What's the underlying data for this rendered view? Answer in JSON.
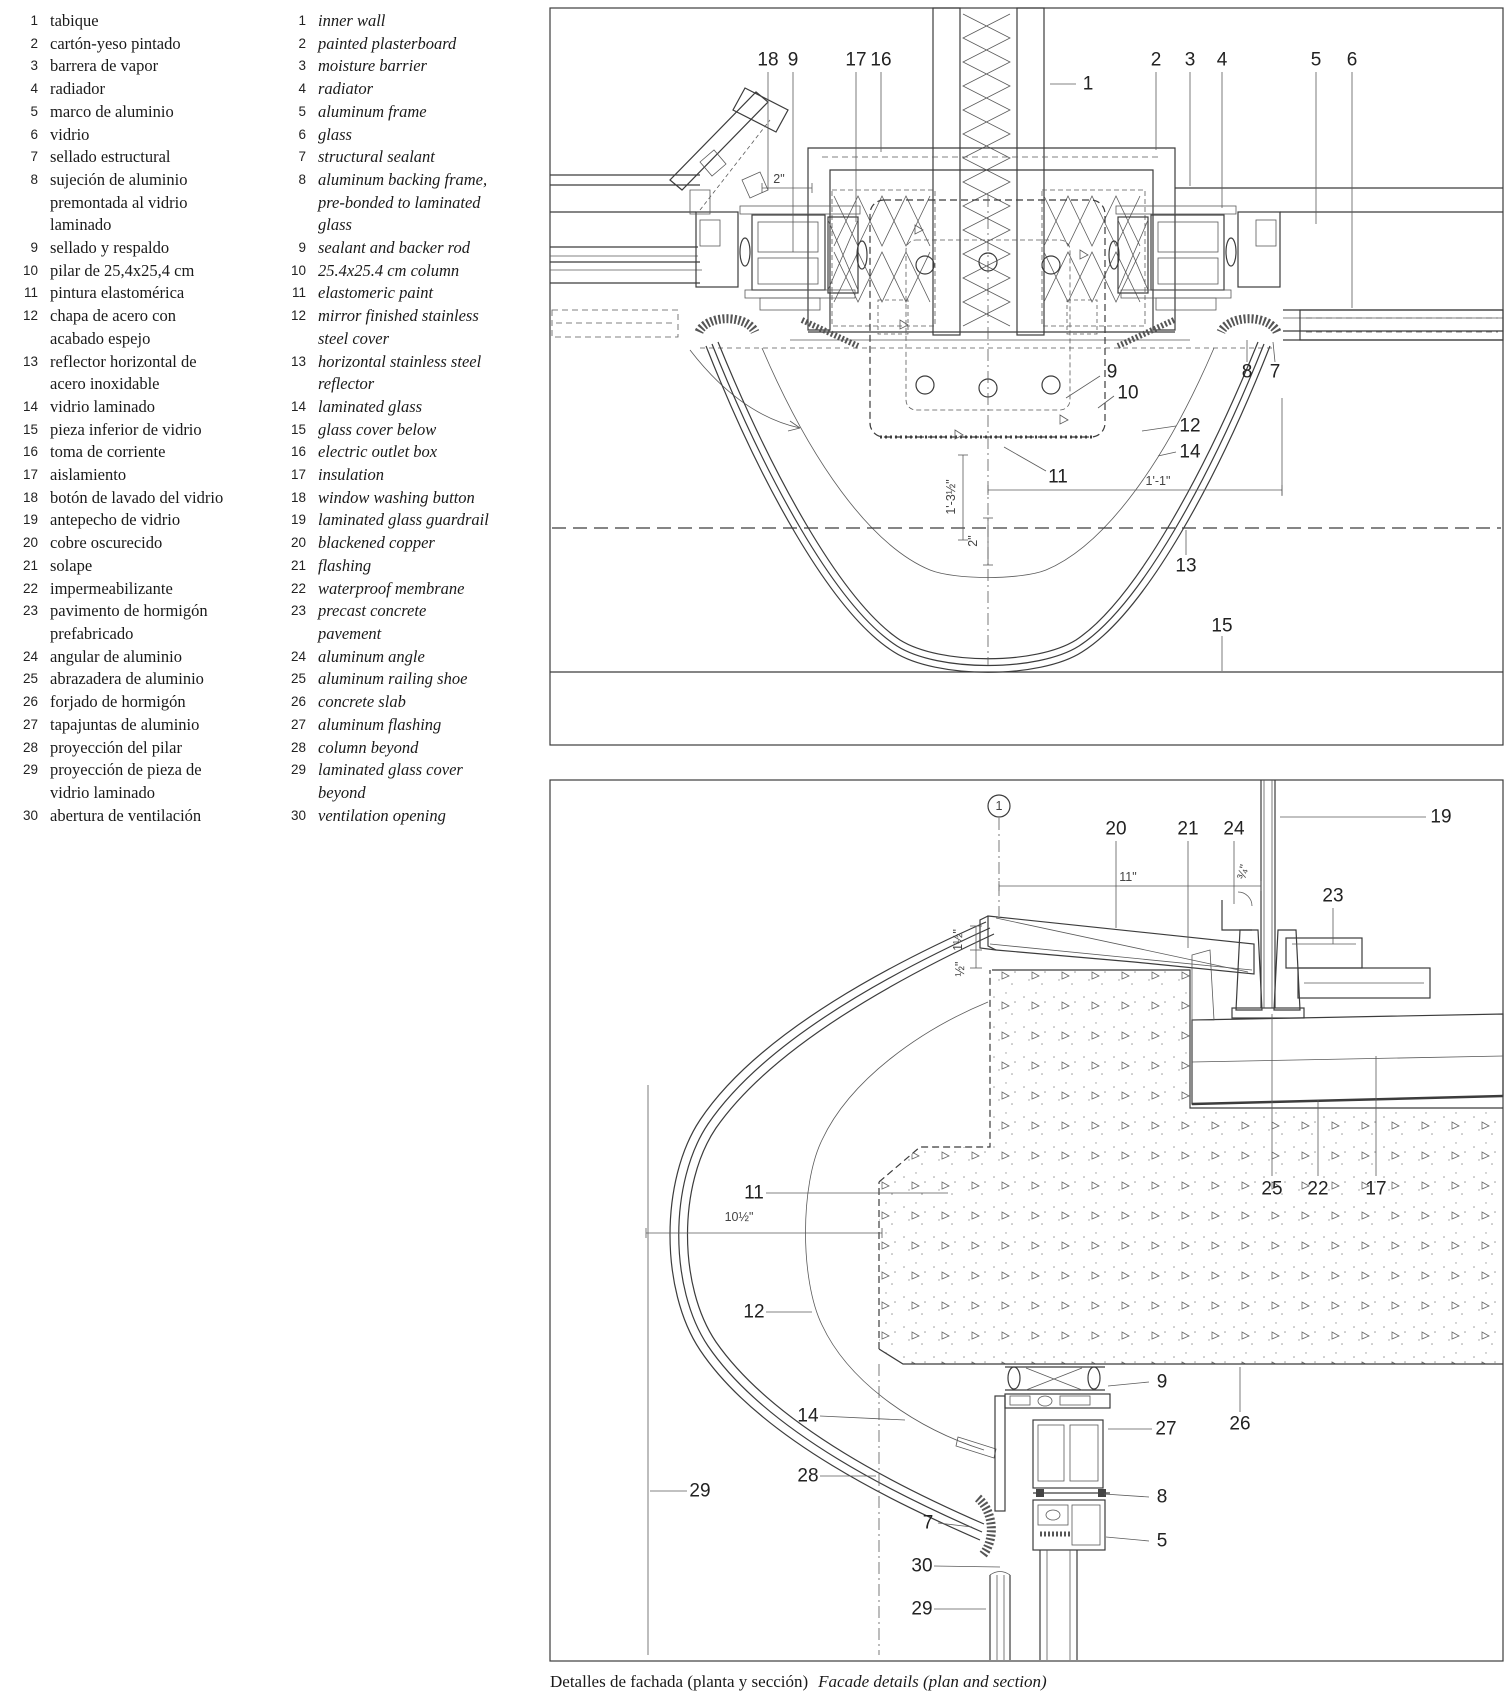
{
  "colors": {
    "line": "#3c3c3c",
    "text": "#1a1a1a",
    "pattern": "#888888"
  },
  "legend": {
    "es": [
      {
        "num": "1",
        "text": "tabique"
      },
      {
        "num": "2",
        "text": "cartón-yeso pintado"
      },
      {
        "num": "3",
        "text": "barrera de vapor"
      },
      {
        "num": "4",
        "text": "radiador"
      },
      {
        "num": "5",
        "text": "marco de aluminio"
      },
      {
        "num": "6",
        "text": "vidrio"
      },
      {
        "num": "7",
        "text": "sellado estructural"
      },
      {
        "num": "8",
        "text": "sujeción de aluminio\npremontada al vidrio\nlaminado"
      },
      {
        "num": "9",
        "text": "sellado y respaldo"
      },
      {
        "num": "10",
        "text": "pilar de 25,4x25,4 cm"
      },
      {
        "num": "11",
        "text": "pintura elastomérica"
      },
      {
        "num": "12",
        "text": "chapa de acero con\nacabado espejo"
      },
      {
        "num": "13",
        "text": "reflector horizontal de\nacero inoxidable"
      },
      {
        "num": "14",
        "text": "vidrio laminado"
      },
      {
        "num": "15",
        "text": "pieza inferior de vidrio"
      },
      {
        "num": "16",
        "text": "toma de corriente"
      },
      {
        "num": "17",
        "text": "aislamiento"
      },
      {
        "num": "18",
        "text": "botón de lavado del vidrio"
      },
      {
        "num": "19",
        "text": "antepecho de vidrio"
      },
      {
        "num": "20",
        "text": "cobre oscurecido"
      },
      {
        "num": "21",
        "text": "solape"
      },
      {
        "num": "22",
        "text": "impermeabilizante"
      },
      {
        "num": "23",
        "text": "pavimento de hormigón\nprefabricado"
      },
      {
        "num": "24",
        "text": "angular de aluminio"
      },
      {
        "num": "25",
        "text": "abrazadera de aluminio"
      },
      {
        "num": "26",
        "text": "forjado de hormigón"
      },
      {
        "num": "27",
        "text": "tapajuntas de aluminio"
      },
      {
        "num": "28",
        "text": "proyección del pilar"
      },
      {
        "num": "29",
        "text": "proyección de pieza de\nvidrio laminado"
      },
      {
        "num": "30",
        "text": "abertura de ventilación"
      }
    ],
    "en": [
      {
        "num": "1",
        "text": "inner wall"
      },
      {
        "num": "2",
        "text": "painted plasterboard"
      },
      {
        "num": "3",
        "text": "moisture barrier"
      },
      {
        "num": "4",
        "text": "radiator"
      },
      {
        "num": "5",
        "text": "aluminum frame"
      },
      {
        "num": "6",
        "text": "glass"
      },
      {
        "num": "7",
        "text": "structural sealant"
      },
      {
        "num": "8",
        "text": "aluminum backing frame,\npre-bonded to laminated\nglass"
      },
      {
        "num": "9",
        "text": "sealant and backer rod"
      },
      {
        "num": "10",
        "text": "25.4x25.4 cm column"
      },
      {
        "num": "11",
        "text": "elastomeric paint"
      },
      {
        "num": "12",
        "text": "mirror finished stainless\nsteel cover"
      },
      {
        "num": "13",
        "text": "horizontal stainless steel\nreflector"
      },
      {
        "num": "14",
        "text": "laminated glass"
      },
      {
        "num": "15",
        "text": "glass cover below"
      },
      {
        "num": "16",
        "text": "electric outlet box"
      },
      {
        "num": "17",
        "text": "insulation"
      },
      {
        "num": "18",
        "text": "window washing button"
      },
      {
        "num": "19",
        "text": "laminated glass guardrail"
      },
      {
        "num": "20",
        "text": "blackened copper"
      },
      {
        "num": "21",
        "text": "flashing"
      },
      {
        "num": "22",
        "text": "waterproof membrane"
      },
      {
        "num": "23",
        "text": "precast concrete\npavement"
      },
      {
        "num": "24",
        "text": "aluminum angle"
      },
      {
        "num": "25",
        "text": "aluminum railing shoe"
      },
      {
        "num": "26",
        "text": "concrete slab"
      },
      {
        "num": "27",
        "text": "aluminum flashing"
      },
      {
        "num": "28",
        "text": "column beyond"
      },
      {
        "num": "29",
        "text": "laminated glass cover\nbeyond"
      },
      {
        "num": "30",
        "text": "ventilation opening"
      }
    ]
  },
  "caption": {
    "es": "Detalles de fachada (planta y sección)",
    "en": "Facade details (plan and section)"
  },
  "plan": {
    "labels": [
      {
        "t": "18",
        "x": 768,
        "y": 60,
        "l": [
          768,
          72,
          768,
          190
        ]
      },
      {
        "t": "9",
        "x": 793,
        "y": 60,
        "l": [
          793,
          72,
          793,
          252
        ]
      },
      {
        "t": "17",
        "x": 856,
        "y": 60,
        "l": [
          856,
          72,
          856,
          222
        ]
      },
      {
        "t": "16",
        "x": 881,
        "y": 60,
        "l": [
          881,
          72,
          881,
          152
        ]
      },
      {
        "t": "1",
        "x": 1088,
        "y": 84,
        "l": [
          1050,
          84,
          1076,
          84
        ]
      },
      {
        "t": "2",
        "x": 1156,
        "y": 60,
        "l": [
          1156,
          72,
          1156,
          150
        ]
      },
      {
        "t": "3",
        "x": 1190,
        "y": 60,
        "l": [
          1190,
          72,
          1190,
          186
        ]
      },
      {
        "t": "4",
        "x": 1222,
        "y": 60,
        "l": [
          1222,
          72,
          1222,
          208
        ]
      },
      {
        "t": "5",
        "x": 1316,
        "y": 60,
        "l": [
          1316,
          72,
          1316,
          224
        ]
      },
      {
        "t": "6",
        "x": 1352,
        "y": 60,
        "l": [
          1352,
          72,
          1352,
          308
        ]
      },
      {
        "t": "9",
        "x": 1112,
        "y": 372,
        "l": [
          1100,
          376,
          1066,
          398
        ]
      },
      {
        "t": "10",
        "x": 1128,
        "y": 393,
        "l": [
          1114,
          396,
          1098,
          408
        ]
      },
      {
        "t": "12",
        "x": 1190,
        "y": 426,
        "l": [
          1176,
          426,
          1142,
          431
        ]
      },
      {
        "t": "14",
        "x": 1190,
        "y": 452,
        "l": [
          1176,
          452,
          1158,
          456
        ]
      },
      {
        "t": "11",
        "x": 1058,
        "y": 477,
        "l": [
          1046,
          471,
          1004,
          447
        ]
      },
      {
        "t": "8",
        "x": 1247,
        "y": 372,
        "l": [
          1247,
          362,
          1247,
          340
        ]
      },
      {
        "t": "7",
        "x": 1275,
        "y": 372,
        "l": [
          1275,
          362,
          1273,
          342
        ]
      },
      {
        "t": "13",
        "x": 1186,
        "y": 566,
        "l": [
          1186,
          555,
          1186,
          530
        ]
      },
      {
        "t": "15",
        "x": 1222,
        "y": 626,
        "l": [
          1222,
          636,
          1222,
          671
        ]
      }
    ],
    "dims": [
      {
        "t": "2\"",
        "x": 779,
        "y": 179,
        "rot": 0
      },
      {
        "t": "1'-3½\"",
        "x": 951,
        "y": 497,
        "rot": -90
      },
      {
        "t": "2\"",
        "x": 973,
        "y": 541,
        "rot": -90
      },
      {
        "t": "1'-1\"",
        "x": 1158,
        "y": 481,
        "rot": 0
      }
    ]
  },
  "section": {
    "circle_mark": {
      "t": "1",
      "x": 999,
      "y": 806
    },
    "labels": [
      {
        "t": "20",
        "x": 1116,
        "y": 829,
        "l": [
          1116,
          841,
          1116,
          928
        ]
      },
      {
        "t": "21",
        "x": 1188,
        "y": 829,
        "l": [
          1188,
          841,
          1188,
          948
        ]
      },
      {
        "t": "24",
        "x": 1234,
        "y": 829,
        "l": [
          1234,
          841,
          1234,
          904
        ]
      },
      {
        "t": "19",
        "x": 1441,
        "y": 817,
        "l": [
          1426,
          817,
          1280,
          817
        ]
      },
      {
        "t": "23",
        "x": 1333,
        "y": 896,
        "l": [
          1333,
          908,
          1333,
          944
        ]
      },
      {
        "t": "25",
        "x": 1272,
        "y": 1189,
        "l": [
          1272,
          1176,
          1272,
          1014
        ]
      },
      {
        "t": "22",
        "x": 1318,
        "y": 1189,
        "l": [
          1318,
          1176,
          1318,
          1100
        ]
      },
      {
        "t": "17",
        "x": 1376,
        "y": 1189,
        "l": [
          1376,
          1176,
          1376,
          1056
        ]
      },
      {
        "t": "11",
        "x": 754,
        "y": 1193,
        "l": [
          766,
          1193,
          948,
          1193
        ]
      },
      {
        "t": "12",
        "x": 754,
        "y": 1312,
        "l": [
          766,
          1312,
          812,
          1312
        ]
      },
      {
        "t": "29",
        "x": 700,
        "y": 1491,
        "l": [
          687,
          1491,
          650,
          1491
        ]
      },
      {
        "t": "14",
        "x": 808,
        "y": 1416,
        "l": [
          820,
          1416,
          905,
          1420
        ]
      },
      {
        "t": "28",
        "x": 808,
        "y": 1476,
        "l": [
          820,
          1476,
          876,
          1476
        ]
      },
      {
        "t": "7",
        "x": 928,
        "y": 1523,
        "l": [
          938,
          1523,
          972,
          1527
        ]
      },
      {
        "t": "30",
        "x": 922,
        "y": 1566,
        "l": [
          934,
          1566,
          1000,
          1567
        ]
      },
      {
        "t": "29",
        "x": 922,
        "y": 1609,
        "l": [
          934,
          1609,
          986,
          1609
        ]
      },
      {
        "t": "9",
        "x": 1162,
        "y": 1382,
        "l": [
          1149,
          1382,
          1108,
          1386
        ]
      },
      {
        "t": "27",
        "x": 1166,
        "y": 1429,
        "l": [
          1152,
          1429,
          1108,
          1429
        ]
      },
      {
        "t": "8",
        "x": 1162,
        "y": 1497,
        "l": [
          1149,
          1497,
          1104,
          1494
        ]
      },
      {
        "t": "5",
        "x": 1162,
        "y": 1541,
        "l": [
          1149,
          1541,
          1106,
          1537
        ]
      },
      {
        "t": "26",
        "x": 1240,
        "y": 1424,
        "l": [
          1240,
          1412,
          1240,
          1367
        ]
      }
    ],
    "dims": [
      {
        "t": "11\"",
        "x": 1128,
        "y": 877,
        "rot": 0
      },
      {
        "t": "1½\"",
        "x": 958,
        "y": 940,
        "rot": -90
      },
      {
        "t": "½\"",
        "x": 960,
        "y": 969,
        "rot": -90
      },
      {
        "t": "¾\"",
        "x": 1243,
        "y": 872,
        "rot": -75
      },
      {
        "t": "10½\"",
        "x": 739,
        "y": 1217,
        "rot": 0
      }
    ]
  }
}
